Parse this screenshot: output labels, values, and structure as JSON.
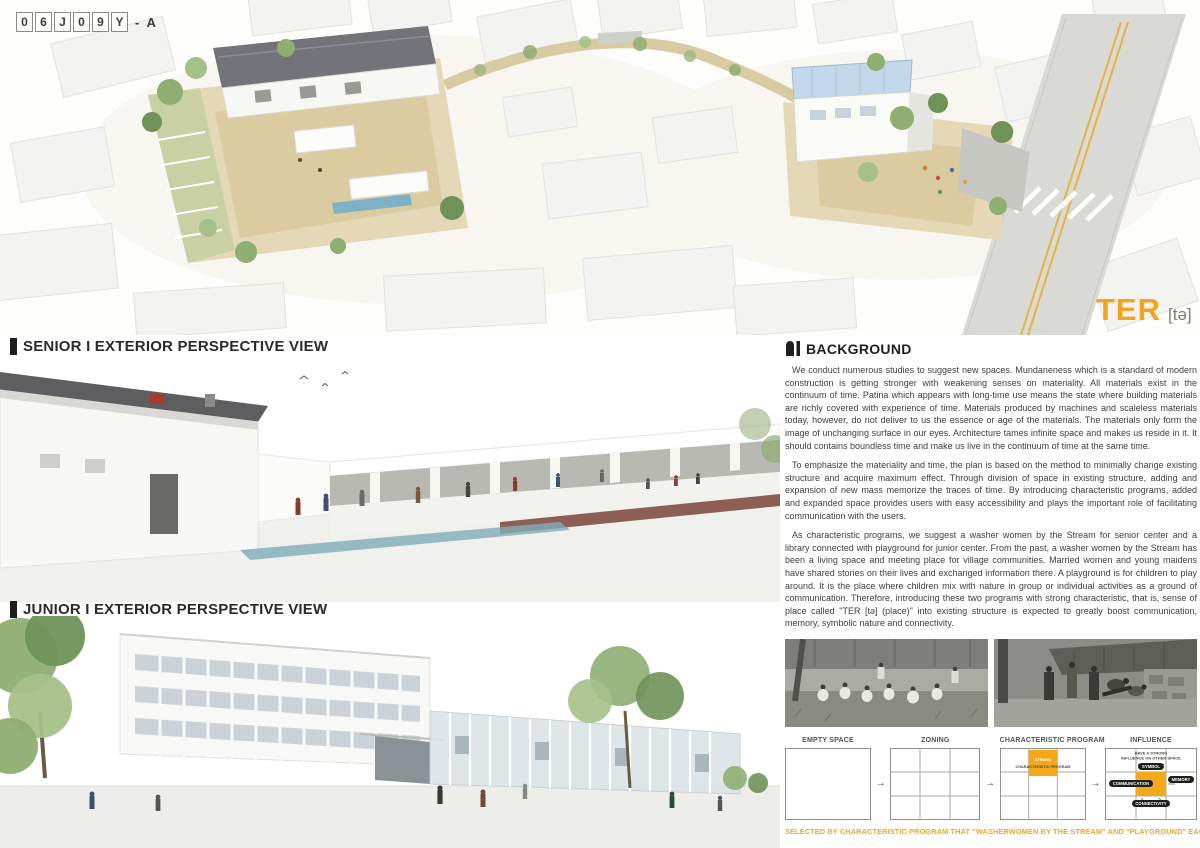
{
  "meta": {
    "code_chars": [
      "0",
      "6",
      "J",
      "0",
      "9",
      "Y"
    ],
    "code_suffix": "- A"
  },
  "logo": {
    "title": "TER",
    "phonetic": "[tə]"
  },
  "sections": {
    "senior_label": "SENIOR I EXTERIOR PERSPECTIVE VIEW",
    "junior_label": "JUNIOR I EXTERIOR PERSPECTIVE VIEW"
  },
  "background": {
    "heading": "BACKGROUND",
    "paragraphs": [
      "We conduct numerous studies to suggest new spaces. Mundaneness which is a standard of modern construction is getting stronger with weakening senses on materiality. All materials exist in the continuum of time. Patina which appears with long-time use means the state where building materials are richly covered with experience of time. Materials produced by machines and scaleless materials today, however, do not deliver to us the essence or age of the materials. The materials only form the image of unchanging surface in our eyes. Architecture tames infinite space and makes us reside in it. It should contains boundless time and make us live in the continuum of time at the same time.",
      "To emphasize the materiality and time, the plan is based on the method to minimally change existing structure and acquire maximum effect. Through division of space in existing structure, adding and expansion of new mass memorize the traces of time. By introducing characteristic programs, added and expanded space provides users with easy accessibility and plays the important role of facilitating communication with the users.",
      "As characteristic programs, we suggest a washer women by the Stream for senior center and a library connected with playground for junior center. From the past, a washer women by the Stream has been a living space and meeting place for village communities. Married women and young maidens have shared stories on their lives and exchanged information there. A playground is for children to play around. It is the place where children mix with nature in group or individual activities as a ground of communication. Therefore, introducing these two programs with strong characteristic, that is, sense of place called \"TER [tə] (place)\" into existing structure is expected to greatly boost communication, memory, symbolic nature and connectivity."
    ]
  },
  "diagram": {
    "steps": [
      {
        "label": "EMPTY SPACE"
      },
      {
        "label": "ZONING"
      },
      {
        "label": "CHARACTERISTIC PROGRAM",
        "cell_line1": "STRONG",
        "cell_line2": "CHARACTERISTIC PROGRAM"
      },
      {
        "label": "INFLUENCE",
        "note_line1": "HAVE A STRONG",
        "note_line2": "INFLUENCE ON OTHER SPACE",
        "pills": [
          "SYMBOL",
          "COMMUNICATION",
          "MEMORY",
          "CONNECTIVITY"
        ]
      }
    ],
    "arrow": "→",
    "caption": "SELECTED BY CHARACTERISTIC PROGRAM THAT \"WASHERWOMEN BY THE STREAM\" AND \"PLAYGROUND\" EACH SITE"
  },
  "colors": {
    "accent_orange": "#F5A31C",
    "ink": "#2b2b29",
    "body_text": "#3e3e3c"
  }
}
